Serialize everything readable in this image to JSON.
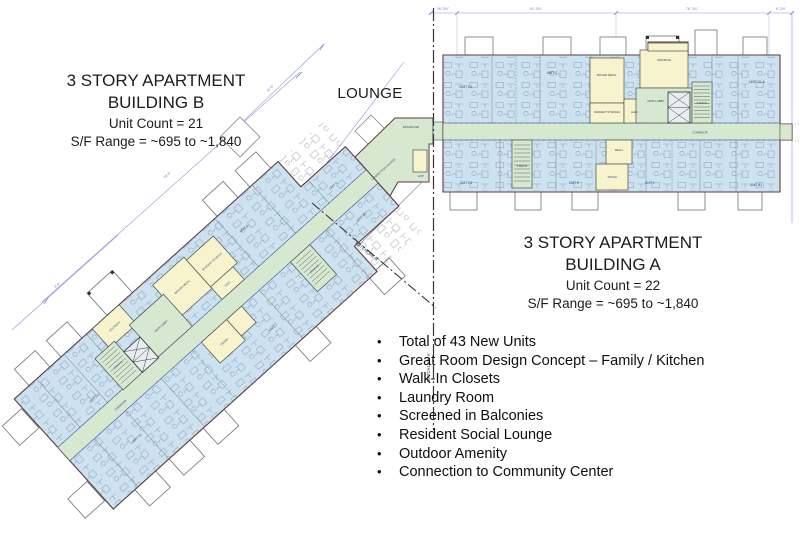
{
  "slide": {
    "bullet_char": "•",
    "lounge_label": "LOUNGE",
    "building_b": {
      "title_line1": "3 STORY APARTMENT",
      "title_line2": "BUILDING B",
      "unit_count": "Unit Count = 21",
      "sf_range": "S/F Range = ~695 to ~1,840"
    },
    "building_a": {
      "title_line1": "3 STORY APARTMENT",
      "title_line2": "BUILDING A",
      "unit_count": "Unit Count = 22",
      "sf_range": "S/F Range = ~695 to ~1,840"
    },
    "bullets": [
      "Total of 43 New Units",
      "Great Room Design Concept – Family / Kitchen",
      "Walk-In Closets",
      "Laundry Room",
      "Screened in Balconies",
      "Resident Social Lounge",
      "Outdoor Amenity",
      "Connection to Community Center"
    ]
  },
  "plan": {
    "colors": {
      "unit_fill": "#cde2f1",
      "circulation_fill": "#d7e8d1",
      "service_fill": "#f7f4cd",
      "wall": "#43474b",
      "exterior_accent": "#8d2b26",
      "dimension_line": "#9094d8",
      "smoke_partition": "#3b5fd0"
    },
    "matchline_a": "MATCHLINE 'A'",
    "matchline_b": "MATCHLINE B",
    "dims_a": {
      "d1": "26'-3½\"",
      "d2": "91'-3⅝\"",
      "d3": "76'-3⅝\"",
      "d4": "6'-2½\""
    },
    "dims_b": {
      "d1": "76'-6\"",
      "d2": "8'-6\"",
      "d3": "41'-6\""
    },
    "rooms_a": {
      "unit_d1_top": "UNIT D1",
      "unit_c": "UNIT C",
      "vestibule": "VESTIBULE",
      "unit_d1a": "UNIT D1-A",
      "boiler": "BOILER MECH.",
      "storage": "RESIDENT STORAGE",
      "elec": "ELEC.",
      "lobby": "MAIN LOBBY",
      "stair1": "STAIR #1",
      "corridor": "CORRIDOR",
      "unit_d1_bot": "UNIT D1",
      "stair2": "STAIR #2",
      "unit_e": "UNIT E",
      "mech": "MECH.",
      "trash": "TRASH",
      "unit_l": "UNIT L",
      "unit_b1": "UNIT B1"
    },
    "rooms_b": {
      "unit_d1": "UNIT D1",
      "unit_a1": "UNIT A1",
      "unit_e": "UNIT E",
      "unit_j": "UNIT J",
      "unit_c": "UNIT C",
      "unit_b1": "UNIT B1",
      "corridor": "CORRIDOR",
      "stair1": "STAIR #1",
      "lobby": "MAIN LOBBY",
      "vestibule": "VESTIBULE",
      "boiler": "BOILER MECH.",
      "storage": "RESIDENT STORAGE",
      "elec": "ELEC.",
      "trash": "TRASH",
      "stair2": "STAIR #2"
    },
    "connector": {
      "bathroom": "BATHROOM",
      "lounge": "CONNECTION LOUNGE",
      "terrace": "TERRACE",
      "exit": "EXIT"
    }
  }
}
